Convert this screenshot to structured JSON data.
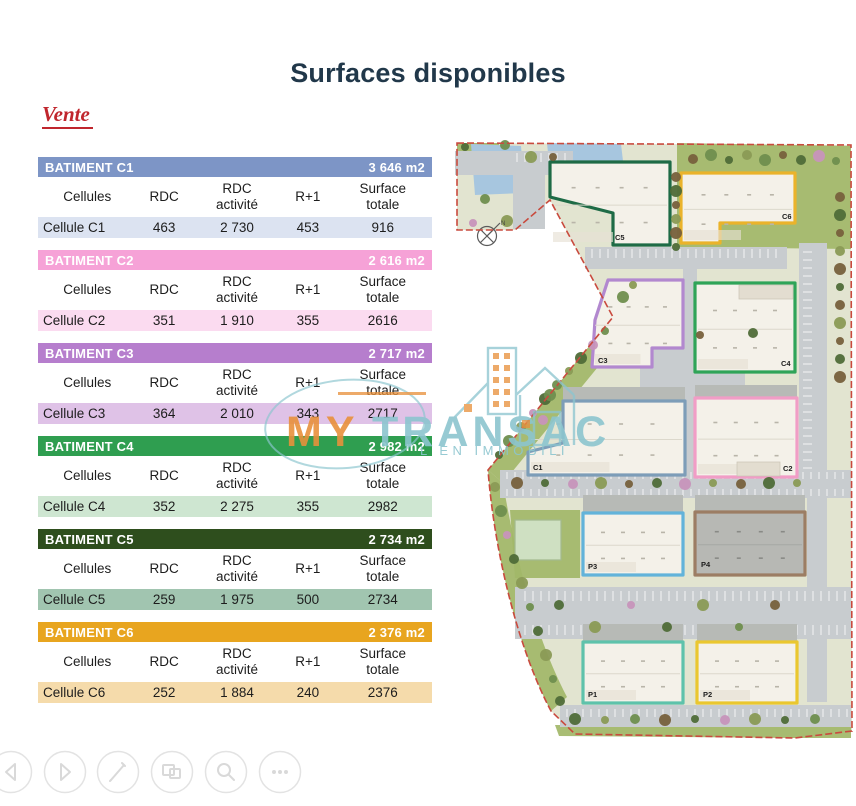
{
  "page": {
    "title": "Surfaces disponibles",
    "section_label": "Vente"
  },
  "columns": [
    "Cellules",
    "RDC",
    "RDC\nactivité",
    "R+1",
    "Surface\ntotale"
  ],
  "tables": [
    {
      "name": "BATIMENT C1",
      "area": "3 646 m2",
      "header_color": "#7d95c6",
      "row_color": "#dce3f1",
      "row": [
        "Cellule C1",
        "463",
        "2 730",
        "453",
        "916"
      ]
    },
    {
      "name": "BATIMENT C2",
      "area": "2 616 m2",
      "header_color": "#f6a2d7",
      "row_color": "#fbdbf0",
      "row": [
        "Cellule C2",
        "351",
        "1 910",
        "355",
        "2616"
      ]
    },
    {
      "name": "BATIMENT C3",
      "area": "2 717 m2",
      "header_color": "#b67ecd",
      "row_color": "#dfc2e7",
      "row": [
        "Cellule C3",
        "364",
        "2 010",
        "343",
        "2717"
      ]
    },
    {
      "name": "BATIMENT C4",
      "area": "2 982 m2",
      "header_color": "#2f9e50",
      "row_color": "#cee6d1",
      "row": [
        "Cellule C4",
        "352",
        "2 275",
        "355",
        "2982"
      ]
    },
    {
      "name": "BATIMENT C5",
      "area": "2 734 m2",
      "header_color": "#2e4e1d",
      "row_color": "#a1c5b0",
      "row": [
        "Cellule C5",
        "259",
        "1 975",
        "500",
        "2734"
      ]
    },
    {
      "name": "BATIMENT C6",
      "area": "2 376 m2",
      "header_color": "#e8a51f",
      "row_color": "#f5dbab",
      "row": [
        "Cellule C6",
        "252",
        "1 884",
        "240",
        "2376"
      ]
    }
  ],
  "watermark": {
    "brand_prefix": "MY",
    "brand_suffix": "TRANSAC",
    "tagline": "L EN IMMOBILI",
    "orange": "#e8913c",
    "teal": "#8cc5cf"
  },
  "map": {
    "compass_label": "N",
    "colors": {
      "land": "#e2e4d0",
      "grass": "#a2b768",
      "road": "#c8cccf",
      "water": "#a7c6df",
      "building": "#f4f1e9",
      "boundary": "#c94a3e",
      "shadow": "#b7bab6",
      "tree_palette": [
        "#6f8e4e",
        "#4f6b38",
        "#8a9a55",
        "#77603c",
        "#c793ba",
        "#8f6a88"
      ]
    },
    "land_path": "M2,8 L396,10 L397,596 L340,603 L120,599 L96,576 C66,520 40,425 33,335 L158,182 L95,65 L60,95 L2,95 Z",
    "grass": [
      "M222,8 L396,11 L396,114 L222,112 Z",
      "M33,335 L158,182 L174,194 L48,348 Z",
      "M33,335 L48,348 C62,430 82,505 112,562 L96,576 C66,520 40,425 33,335 Z",
      "M100,590 L396,592 L396,603 L340,603 L104,601 Z",
      "M55,375 L125,375 L125,443 L60,443 Z",
      "M2,8 L44,8 L44,16 L2,16 Z"
    ],
    "water": [
      "M16,9 L66,11 L70,58 L20,60 Z",
      "M92,8 L166,9 L168,26 L94,28 Z"
    ],
    "roads": [
      [
        0,
        16,
        118,
        24
      ],
      [
        58,
        40,
        32,
        54
      ],
      [
        228,
        112,
        14,
        233
      ],
      [
        130,
        112,
        202,
        22
      ],
      [
        185,
        208,
        105,
        58
      ],
      [
        45,
        335,
        351,
        28
      ],
      [
        60,
        452,
        336,
        52
      ],
      [
        105,
        570,
        291,
        22
      ],
      [
        344,
        108,
        28,
        232
      ],
      [
        352,
        345,
        20,
        222
      ]
    ],
    "stripes": [
      [
        133,
        113,
        195,
        11,
        "v"
      ],
      [
        48,
        336,
        344,
        9,
        "v"
      ],
      [
        48,
        353,
        344,
        9,
        "v"
      ],
      [
        66,
        455,
        326,
        12,
        "v"
      ],
      [
        66,
        489,
        326,
        12,
        "v"
      ],
      [
        108,
        573,
        286,
        10,
        "v"
      ],
      [
        347,
        114,
        11,
        226,
        "h"
      ],
      [
        58,
        17,
        54,
        11,
        "v"
      ]
    ],
    "shadows": [
      [
        108,
        252,
        122,
        14
      ],
      [
        240,
        250,
        102,
        13
      ],
      [
        128,
        360,
        100,
        17
      ],
      [
        240,
        360,
        110,
        17
      ],
      [
        128,
        489,
        100,
        17
      ],
      [
        242,
        489,
        100,
        17
      ]
    ],
    "annex": {
      "rect": [
        60,
        385,
        46,
        40
      ],
      "fill": "#cfe0c2",
      "stroke": "#a3b98e"
    },
    "buildings": [
      {
        "label": "C5",
        "color": "#1e6b46",
        "path": "M95,27 L215,27 L215,110 L158,110 L158,78 L95,62 Z",
        "box": [
          95,
          27,
          120,
          83
        ],
        "label_pos": [
          160,
          105
        ]
      },
      {
        "label": "C6",
        "color": "#eab32b",
        "path": "M226,38 L340,38 L340,88 L265,88 L265,108 L226,108 Z",
        "box": [
          226,
          38,
          114,
          70
        ],
        "label_pos": [
          327,
          84
        ]
      },
      {
        "label": "C3",
        "color": "#b288cf",
        "path": "M153,145 L228,145 L228,213 L197,213 L197,232 L137,232 L140,185 Z",
        "box": [
          137,
          145,
          91,
          87
        ],
        "label_pos": [
          143,
          228
        ]
      },
      {
        "label": "C4",
        "color": "#2fa458",
        "path": "M240,148 L340,148 L340,237 L240,237 Z",
        "box": [
          240,
          148,
          100,
          89
        ],
        "label_pos": [
          326,
          231
        ],
        "inner": [
          284,
          150,
          54,
          14
        ]
      },
      {
        "label": "C1",
        "color": "#7d9db8",
        "path": "M108,266 L230,266 L230,340 L73,340 L73,317 L108,308 Z",
        "box": [
          73,
          266,
          157,
          74
        ],
        "label_pos": [
          78,
          335
        ]
      },
      {
        "label": "C2",
        "color": "#f19dc6",
        "path": "M240,263 L342,263 L342,342 L240,342 Z",
        "box": [
          240,
          263,
          102,
          79
        ],
        "label_pos": [
          328,
          336
        ],
        "inner": [
          282,
          327,
          43,
          14
        ]
      },
      {
        "label": "P3",
        "color": "#62b3da",
        "path": "M128,378 L228,378 L228,440 L128,440 Z",
        "box": [
          128,
          378,
          100,
          62
        ],
        "label_pos": [
          133,
          434
        ]
      },
      {
        "label": "P4",
        "color": "#9c7d64",
        "fill": "#b7b8b4",
        "path": "M240,377 L350,377 L350,440 L240,440 Z",
        "box": [
          240,
          377,
          110,
          63
        ],
        "label_pos": [
          246,
          432
        ]
      },
      {
        "label": "P1",
        "color": "#5ec2ab",
        "path": "M128,507 L228,507 L228,568 L128,568 Z",
        "box": [
          128,
          507,
          100,
          61
        ],
        "label_pos": [
          133,
          562
        ]
      },
      {
        "label": "P2",
        "color": "#eac72f",
        "path": "M242,507 L342,507 L342,568 L242,568 Z",
        "box": [
          242,
          507,
          100,
          61
        ],
        "label_pos": [
          248,
          562
        ]
      }
    ],
    "trees": [
      [
        10,
        12,
        1
      ],
      [
        50,
        10,
        0
      ],
      [
        76,
        22,
        2
      ],
      [
        98,
        22,
        3
      ],
      [
        30,
        64,
        0
      ],
      [
        52,
        86,
        2
      ],
      [
        18,
        88,
        4
      ],
      [
        238,
        24,
        3
      ],
      [
        256,
        20,
        0
      ],
      [
        274,
        25,
        1
      ],
      [
        292,
        20,
        2
      ],
      [
        310,
        25,
        0
      ],
      [
        328,
        20,
        3
      ],
      [
        346,
        25,
        1
      ],
      [
        364,
        21,
        4
      ],
      [
        381,
        26,
        0
      ],
      [
        221,
        42,
        3
      ],
      [
        221,
        56,
        1
      ],
      [
        221,
        70,
        3
      ],
      [
        221,
        84,
        2
      ],
      [
        221,
        98,
        3
      ],
      [
        221,
        112,
        1
      ],
      [
        385,
        62,
        3
      ],
      [
        385,
        80,
        1
      ],
      [
        385,
        98,
        3
      ],
      [
        385,
        116,
        2
      ],
      [
        385,
        134,
        3
      ],
      [
        385,
        152,
        1
      ],
      [
        385,
        170,
        3
      ],
      [
        385,
        188,
        2
      ],
      [
        385,
        206,
        3
      ],
      [
        385,
        224,
        1
      ],
      [
        385,
        242,
        3
      ],
      [
        150,
        196,
        0
      ],
      [
        138,
        210,
        4
      ],
      [
        126,
        223,
        1
      ],
      [
        114,
        236,
        2
      ],
      [
        102,
        250,
        0
      ],
      [
        90,
        264,
        1
      ],
      [
        78,
        278,
        4
      ],
      [
        66,
        292,
        2
      ],
      [
        54,
        306,
        0
      ],
      [
        44,
        320,
        1
      ],
      [
        40,
        352,
        2
      ],
      [
        46,
        376,
        0
      ],
      [
        52,
        400,
        4
      ],
      [
        59,
        424,
        1
      ],
      [
        67,
        448,
        2
      ],
      [
        75,
        472,
        0
      ],
      [
        83,
        496,
        1
      ],
      [
        91,
        520,
        2
      ],
      [
        98,
        544,
        0
      ],
      [
        105,
        566,
        1
      ],
      [
        62,
        348,
        3
      ],
      [
        90,
        348,
        1
      ],
      [
        118,
        349,
        4
      ],
      [
        146,
        348,
        2
      ],
      [
        174,
        349,
        3
      ],
      [
        202,
        348,
        1
      ],
      [
        230,
        349,
        4
      ],
      [
        258,
        348,
        2
      ],
      [
        286,
        349,
        3
      ],
      [
        314,
        348,
        1
      ],
      [
        342,
        348,
        2
      ],
      [
        104,
        470,
        1
      ],
      [
        140,
        492,
        2
      ],
      [
        176,
        470,
        4
      ],
      [
        212,
        492,
        1
      ],
      [
        248,
        470,
        2
      ],
      [
        284,
        492,
        0
      ],
      [
        320,
        470,
        3
      ],
      [
        120,
        584,
        1
      ],
      [
        150,
        585,
        2
      ],
      [
        180,
        584,
        0
      ],
      [
        210,
        585,
        3
      ],
      [
        240,
        584,
        1
      ],
      [
        270,
        585,
        4
      ],
      [
        300,
        584,
        2
      ],
      [
        330,
        585,
        1
      ],
      [
        360,
        584,
        0
      ],
      [
        168,
        162,
        0
      ],
      [
        178,
        150,
        2
      ],
      [
        88,
        285,
        4
      ],
      [
        95,
        260,
        0
      ],
      [
        245,
        200,
        3
      ],
      [
        298,
        198,
        1
      ]
    ]
  },
  "toolbar": {
    "buttons": [
      {
        "name": "previous"
      },
      {
        "name": "next"
      },
      {
        "name": "edit-pen"
      },
      {
        "name": "copy-images"
      },
      {
        "name": "zoom-search"
      },
      {
        "name": "more-options"
      }
    ]
  }
}
